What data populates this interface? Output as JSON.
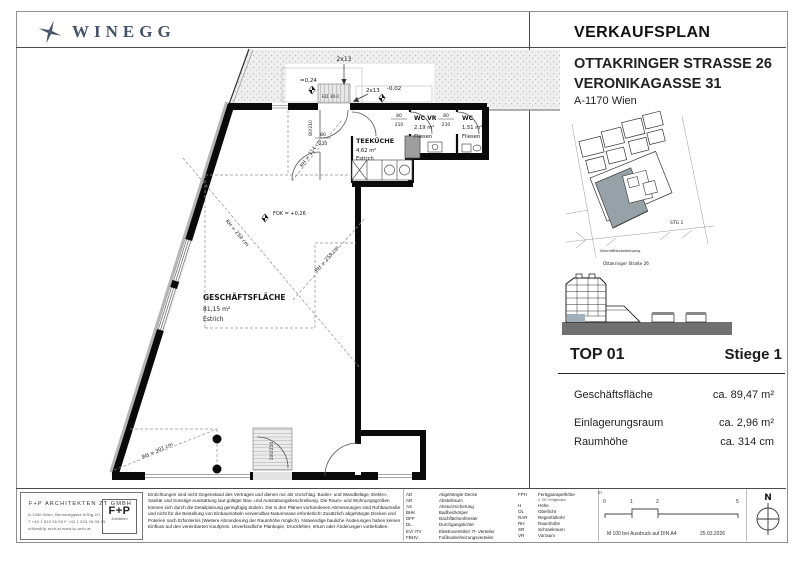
{
  "brand": {
    "name": "WINEGG"
  },
  "header": {
    "title": "VERKAUFSPLAN",
    "address_line1": "OTTAKRINGER STRASSE 26",
    "address_line2": "VERONIKAGASSE 31",
    "city": "A-1170 Wien"
  },
  "site_map": {
    "stg_label": "STG 1",
    "entrance_label": "Geschäftslokaleingang",
    "street_label": "Ottakringer Straße 26"
  },
  "unit": {
    "top": "TOP 01",
    "stiege": "Stiege 1",
    "rows": [
      {
        "label": "Geschäftsfläche",
        "value": "ca. 89,47 m²"
      },
      {
        "label": "Einlagerungsraum",
        "value": "ca. 2,96 m²"
      },
      {
        "label": "Raumhöhe",
        "value": "ca. 314 cm"
      }
    ]
  },
  "plan": {
    "geschaeftsflaeche": {
      "name": "GESCHÄFTSFLÄCHE",
      "area": "81,15 m²",
      "floor": "Estrich"
    },
    "teekueche": {
      "name": "TEEKÜCHE",
      "area": "4,62 m²",
      "floor": "Estrich"
    },
    "wc_vr": {
      "name": "WC VR",
      "area": "2,19 m²",
      "floor": "Fliesen"
    },
    "wc": {
      "name": "WC",
      "area": "1,51 m²",
      "floor": "Fliesen"
    },
    "annotations": {
      "stair_top": "2x13",
      "stair_mid": "2x13",
      "level_top": "=0,24",
      "level_entry": "-0,02",
      "fire_door": "EI2 30-C",
      "fok": "FOK = +0,26",
      "rh_entry": "RH = 314 cm",
      "rh_mid_left": "RH = 259 cm",
      "rh_mid_right": "RH = 259 cm",
      "rh_bottom": "RH = 301 cm",
      "door_w": "80",
      "door_h": "210",
      "door_top": "80/210",
      "door_entry": "100/250"
    }
  },
  "architect": {
    "name": "F+P ARCHITEKTEN ZT GMBH",
    "address": "A-1060 Wien, Bernardgasse 6/Stg.2/1",
    "phone": "T +43 1 523 26 05    F +43 1 523 26 05-15",
    "web": "office@fp-arch.at    www.fp-arch.at",
    "logo": "F+P",
    "logo_sub": "Architekten"
  },
  "legal": "Einrichtungen sind nicht Gegenstand des Vertrages und dienen nur als Vorschlag. Boden- und Wandbeläge, Elektro-, Sanitär und Sonstige Ausstattung laut gültiger Bau- und Ausstattungsbeschreibung. Die Raum- und Wohnungsgrößen können sich durch die Detailplanung geringfügig ändern. Die in den Plänen vorhandenen Abmessungen sind Rohbaumaße und nicht für die Bestellung von Einbaumöbeln verwendbar-Naturmasse erforderlich! Zusätzlich abgehängte Decken und Poterien nach Erfordernis (Weitere Abminderung der Raumhöhe möglich). Notwendige bauliche Änderungen haben keinen Einfluss auf den vereinbarten Kaufpreis. Unverbindliche Plankopie, Druckfehler, Irrtum oder Änderungen vorbehalten.",
  "legend": {
    "left": [
      {
        "abbr": "AD",
        "label": "Abgehängte Decke"
      },
      {
        "abbr": "AR",
        "label": "Abstellraum"
      },
      {
        "abbr": "AS",
        "label": "Absturzsicherung"
      },
      {
        "abbr": "BHK",
        "label": "Badheizkörper"
      },
      {
        "abbr": "DFF",
        "label": "Dachflächenfenster"
      },
      {
        "abbr": "DL",
        "label": "Durchgangslichte"
      },
      {
        "abbr": "EV/ ITV",
        "label": "Elektroverteiler/ IT- Verteiler"
      },
      {
        "abbr": "FBHV",
        "label": "Fußbodenheizungsverteiler"
      }
    ],
    "right": [
      {
        "abbr": "FPH",
        "label": "Fertigparapethöhe"
      },
      {
        "abbr": "H",
        "label": "Höhe"
      },
      {
        "abbr": "OL",
        "label": "Oberlicht"
      },
      {
        "abbr": "RAR",
        "label": "Regenfallrohr"
      },
      {
        "abbr": "RH",
        "label": "Raumhöhe"
      },
      {
        "abbr": "SR",
        "label": "Schrankraum"
      },
      {
        "abbr": "VR",
        "label": "Vorraum"
      }
    ],
    "fph_note": "ü. OK Fertigboden"
  },
  "scale": {
    "unit_label": "m",
    "t0": "0",
    "t1": "1",
    "t2": "2",
    "t3": "5",
    "note": "M 100 bei Ausdruck auf DIN A4",
    "date": "25.03.2026"
  },
  "compass": {
    "label": "N"
  }
}
